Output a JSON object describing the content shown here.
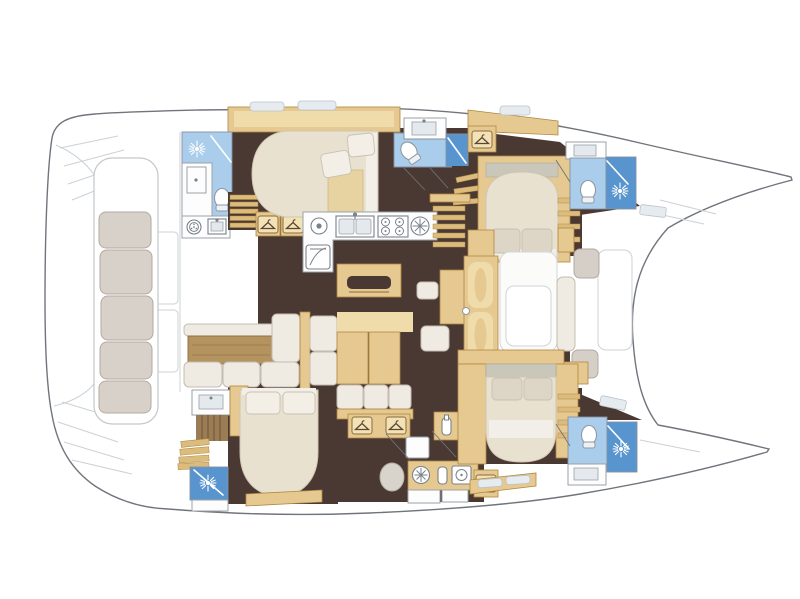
{
  "figure": {
    "kind": "catamaran-yacht-interior-floor-plan",
    "aria_label": "Top-view interior layout plan of a four-cabin sailing catamaran",
    "visible_text": []
  },
  "colors": {
    "hull_outline": "#70757c",
    "deck_line": "#ccd1d5",
    "floor_dark": "#4a3833",
    "wood_tan": "#e6c991",
    "wood_tan_light": "#f0dcab",
    "wood_tan_border": "#b08840",
    "wood_dark": "#b5935f",
    "wood_dark_border": "#8a6a3f",
    "wood_step": "#dcbc7d",
    "wood_slat_dark": "#6e5436",
    "counter_white": "#fdfdfd",
    "counter_border": "#9aa2a9",
    "room_border": "#8791a0",
    "bath_blue": "#a9cdeb",
    "bath_blue_deep": "#5895ce",
    "cushion_white": "#efeae2",
    "cushion_border": "#c4bcb0",
    "cushion_gray": "#d6cfc8",
    "cushion_gray_border": "#b2a99f",
    "bench_beige": "#d8d1c9",
    "bench_border": "#b3aaa0",
    "bed_cream": "#e9e1d0",
    "bed_border": "#cfc5b2",
    "pillow": "#f3efe7",
    "pillow_border": "#c8c0b2",
    "icon_line": "#79828a",
    "door_line": "#6f7478",
    "hatch": "#e6ebf0"
  },
  "icons": {
    "shower_sun_icon": "white sunburst on blue shower pan",
    "toilet_icon": "white oval bowl with cistern",
    "sink_icon": "rectangular basin with faucet dot",
    "double_sink_icon": "two square galley basins with mixer tap",
    "stove_icon": "four-burner cooktop circles",
    "washing_machine_icon": "front-loader ring with drum dots",
    "fridge_icon": "square door with swing curve",
    "wardrobe_hanger_icon": "clothes hanger on locker plaque",
    "porthole_icon": "round plate with spokes",
    "bottle_icon": "tall bottle in rack",
    "oven_icon": "square appliance with round door"
  },
  "plan_features": {
    "hulls": 2,
    "double_berths": 4,
    "bathrooms_with_shower": 5,
    "galley": "L-shaped with double sink, 4-burner stove, fridge",
    "salon": "sofa group with low wood table and island unit",
    "aft_cockpit": "long bench with five cushions and transom steps",
    "forward_cockpit": "lounge pads and table between bows"
  }
}
